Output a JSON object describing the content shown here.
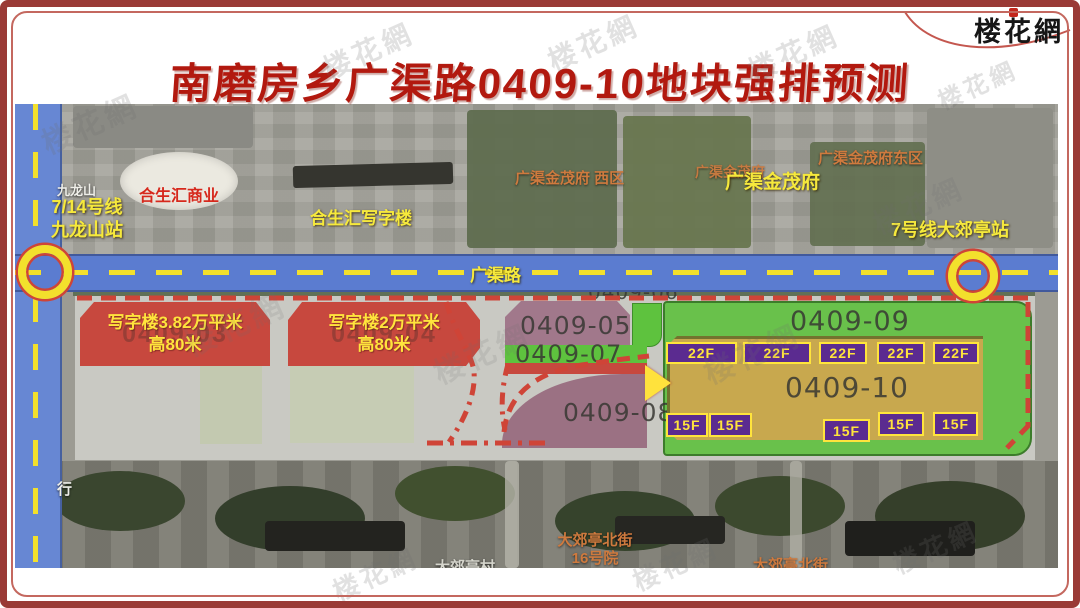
{
  "header": {
    "title": "南磨房乡广渠路0409-10地块强排预测",
    "logo": "楼花網"
  },
  "watermark": "楼花網",
  "roads": {
    "guangqu": "广渠路"
  },
  "stations": {
    "jiulongshan_area": "九龙山",
    "left_line1": "7/14号线",
    "left_line2": "九龙山站",
    "right": "7号线大郊亭站"
  },
  "landmarks": {
    "mall": "合生汇商业",
    "office": "合生汇写字楼",
    "jinmao_west": "广渠金茂府 西区",
    "jinmao_back": "广渠金茂府",
    "jinmao_front": "广渠金茂府",
    "jinmao_east": "广渠金茂府东区",
    "street_word": "行",
    "village": "大郊亭村",
    "street16_l1": "大郊亭北街",
    "street16_l2": "16号院",
    "street_right": "大郊亭北街"
  },
  "plots": {
    "officeA": {
      "l1": "写字楼3.82万平米",
      "l2": "高80米",
      "ghost": "0409-03"
    },
    "officeB": {
      "l1": "写字楼2万平米",
      "l2": "高80米",
      "ghost": "0409-04"
    },
    "p05": "0409-05",
    "p06": "0409-06",
    "p07": "0409-07",
    "p08": "0409-08",
    "p09": "0409-09",
    "p10": "0409-10",
    "b22": [
      "22F",
      "22F",
      "22F",
      "22F",
      "22F"
    ],
    "b15": [
      "15F",
      "15F",
      "15F",
      "15F",
      "15F"
    ]
  },
  "colors": {
    "title_red": "#b2190f",
    "frame_red": "#9a3a36",
    "road_blue": "#5b7cd0",
    "dash_yellow": "#f3e02c",
    "office_block_red": "#c7483e",
    "plot_green": "#69c14b",
    "plot_tan": "#c8a84e",
    "plot_mauve": "#9b7183",
    "badge_purple": "#5b2b90",
    "badge_yellow": "#ffe43c",
    "label_orange": "#cf7a3e"
  }
}
